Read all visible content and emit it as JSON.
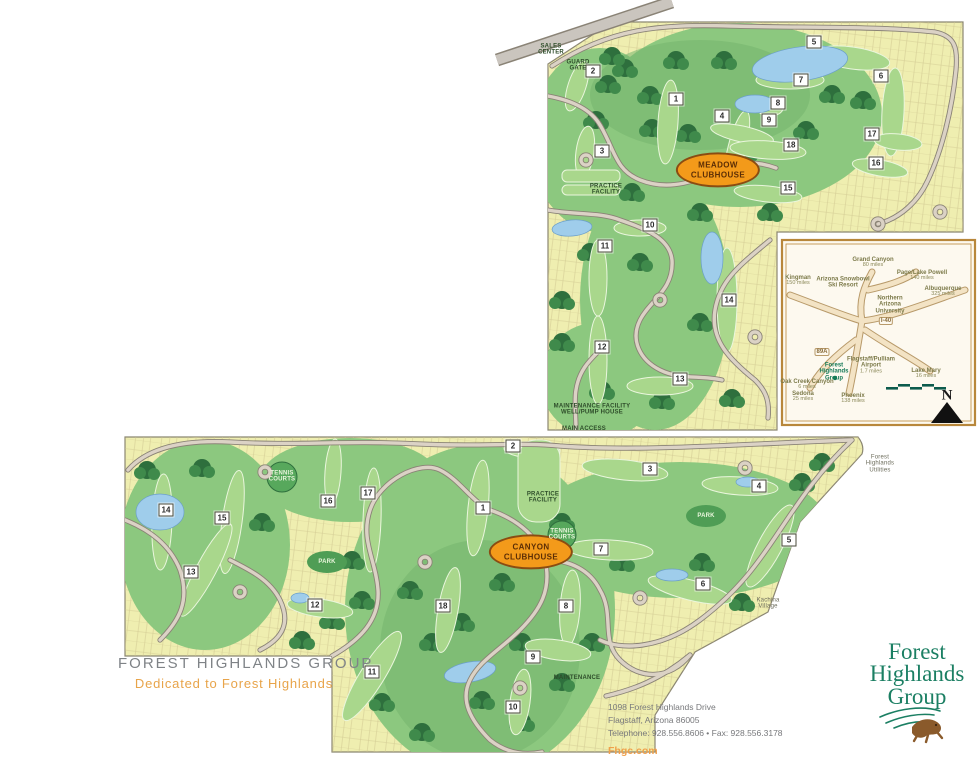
{
  "page": {
    "width": 980,
    "height": 766,
    "background": "#ffffff"
  },
  "branding": {
    "group_title": "FOREST HIGHLANDS GROUP",
    "tagline": "Dedicated to Forest Highlands",
    "title_color": "#7f8387",
    "tagline_color": "#e8a44a"
  },
  "footer": {
    "address_line1": "1098 Forest Highlands Drive",
    "address_line2": "Flagstaff, Arizona 86005",
    "contact_line": "Telephone: 928.556.8606  •  Fax: 928.556.3178",
    "website": "Fhgc.com"
  },
  "logo": {
    "line1": "Forest",
    "line2": "Highlands",
    "line3": "Group",
    "color": "#1b7f63",
    "mascot": "running-gopher-icon"
  },
  "meadow_course": {
    "clubhouse_line1": "MEADOW",
    "clubhouse_line2": "CLUBHOUSE",
    "clubhouse_color": "#f39a1a",
    "holes": [
      {
        "n": 1,
        "x": 676,
        "y": 99
      },
      {
        "n": 2,
        "x": 593,
        "y": 71
      },
      {
        "n": 3,
        "x": 602,
        "y": 151
      },
      {
        "n": 4,
        "x": 722,
        "y": 116
      },
      {
        "n": 5,
        "x": 814,
        "y": 42
      },
      {
        "n": 6,
        "x": 881,
        "y": 76
      },
      {
        "n": 7,
        "x": 801,
        "y": 80
      },
      {
        "n": 8,
        "x": 778,
        "y": 103
      },
      {
        "n": 9,
        "x": 769,
        "y": 120
      },
      {
        "n": 10,
        "x": 650,
        "y": 225
      },
      {
        "n": 11,
        "x": 605,
        "y": 246
      },
      {
        "n": 12,
        "x": 602,
        "y": 347
      },
      {
        "n": 13,
        "x": 680,
        "y": 379
      },
      {
        "n": 14,
        "x": 729,
        "y": 300
      },
      {
        "n": 15,
        "x": 788,
        "y": 188
      },
      {
        "n": 16,
        "x": 876,
        "y": 163
      },
      {
        "n": 17,
        "x": 872,
        "y": 134
      },
      {
        "n": 18,
        "x": 791,
        "y": 145
      }
    ],
    "labels": [
      {
        "text": "PRACTICE\nFACILITY",
        "x": 606,
        "y": 190
      },
      {
        "text": "SALES\nCENTER",
        "x": 551,
        "y": 50
      },
      {
        "text": "GUARD\nGATE",
        "x": 578,
        "y": 66
      },
      {
        "text": "MAINTENANCE FACILITY\nWELL/PUMP HOUSE",
        "x": 592,
        "y": 410
      },
      {
        "text": "MAIN ACCESS",
        "x": 584,
        "y": 429
      }
    ]
  },
  "canyon_course": {
    "clubhouse_line1": "CANYON",
    "clubhouse_line2": "CLUBHOUSE",
    "clubhouse_color": "#f39a1a",
    "holes": [
      {
        "n": 1,
        "x": 483,
        "y": 508
      },
      {
        "n": 2,
        "x": 513,
        "y": 446
      },
      {
        "n": 3,
        "x": 650,
        "y": 469
      },
      {
        "n": 4,
        "x": 759,
        "y": 486
      },
      {
        "n": 5,
        "x": 789,
        "y": 540
      },
      {
        "n": 6,
        "x": 703,
        "y": 584
      },
      {
        "n": 7,
        "x": 601,
        "y": 549
      },
      {
        "n": 8,
        "x": 566,
        "y": 606
      },
      {
        "n": 9,
        "x": 533,
        "y": 657
      },
      {
        "n": 10,
        "x": 513,
        "y": 707
      },
      {
        "n": 11,
        "x": 372,
        "y": 672
      },
      {
        "n": 12,
        "x": 315,
        "y": 605
      },
      {
        "n": 13,
        "x": 191,
        "y": 572
      },
      {
        "n": 14,
        "x": 166,
        "y": 510
      },
      {
        "n": 15,
        "x": 222,
        "y": 518
      },
      {
        "n": 16,
        "x": 328,
        "y": 501
      },
      {
        "n": 17,
        "x": 368,
        "y": 493
      },
      {
        "n": 18,
        "x": 443,
        "y": 606
      }
    ],
    "labels": [
      {
        "text": "PRACTICE\nFACILITY",
        "x": 543,
        "y": 498
      },
      {
        "text": "TENNIS\nCOURTS",
        "x": 282,
        "y": 477,
        "cls": "on-green"
      },
      {
        "text": "TENNIS\nCOURTS",
        "x": 562,
        "y": 535,
        "cls": "on-green"
      },
      {
        "text": "PARK",
        "x": 327,
        "y": 562,
        "cls": "on-green"
      },
      {
        "text": "PARK",
        "x": 706,
        "y": 516,
        "cls": "on-green"
      },
      {
        "text": "MAINTENANCE",
        "x": 577,
        "y": 678
      },
      {
        "text": "Kachina\nVillage",
        "x": 768,
        "y": 604,
        "cls": "village"
      },
      {
        "text": "Forest\nHighlands\nUtilities",
        "x": 880,
        "y": 464,
        "cls": "village"
      }
    ]
  },
  "inset_map": {
    "border_color": "#b8873b",
    "destinations": [
      {
        "name": "Grand Canyon",
        "distance": "80 miles",
        "x": 873,
        "y": 263
      },
      {
        "name": "Page/Lake Powell",
        "distance": "140 miles",
        "x": 922,
        "y": 276
      },
      {
        "name": "Kingman",
        "distance": "150 miles",
        "x": 798,
        "y": 281
      },
      {
        "name": "Albuquerque",
        "distance": "325 miles",
        "x": 943,
        "y": 292
      },
      {
        "name": "Arizona Snowbowl\nSki Resort",
        "distance": "",
        "x": 843,
        "y": 283
      },
      {
        "name": "Northern\nArizona\nUniversity",
        "distance": "",
        "x": 890,
        "y": 305
      },
      {
        "name": "Flagstaff/Pulliam\nAirport",
        "distance": "1.7 miles",
        "x": 871,
        "y": 366
      },
      {
        "name": "Lake Mary",
        "distance": "16 miles",
        "x": 926,
        "y": 374
      },
      {
        "name": "Forest\nHighlands\nGroup",
        "distance": "",
        "x": 834,
        "y": 372,
        "cls": "fhg"
      },
      {
        "name": "Oak Creek Canyon",
        "distance": "6 miles",
        "x": 807,
        "y": 385
      },
      {
        "name": "Sedona",
        "distance": "25 miles",
        "x": 803,
        "y": 397
      },
      {
        "name": "Phoenix",
        "distance": "138 miles",
        "x": 853,
        "y": 399
      }
    ],
    "road_labels": [
      {
        "text": "I-40",
        "x": 886,
        "y": 321
      },
      {
        "text": "89A",
        "x": 822,
        "y": 352
      }
    ],
    "compass_label": "N"
  }
}
